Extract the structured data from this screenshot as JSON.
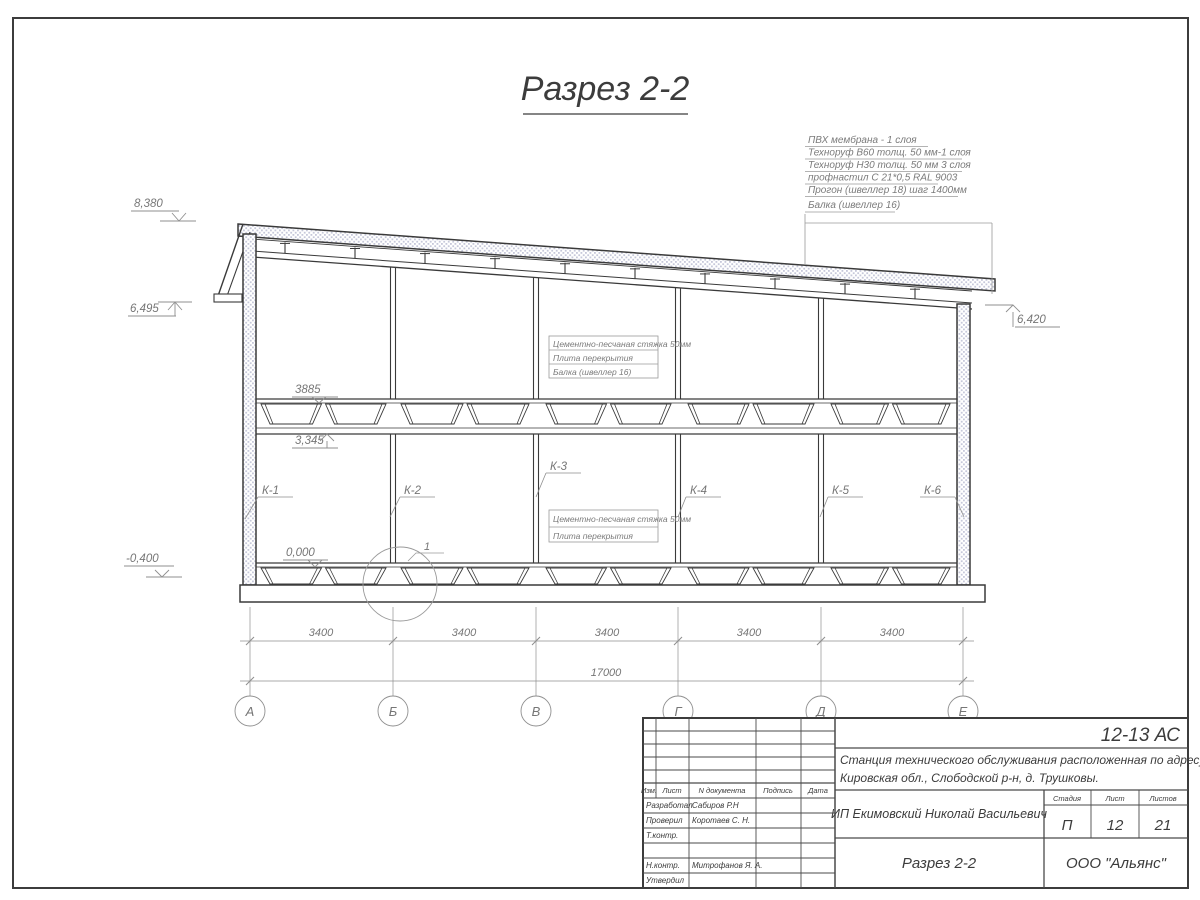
{
  "drawing": {
    "title": "Разрез 2-2"
  },
  "roof_callout": {
    "lines": [
      "ПВХ мембрана - 1 слоя",
      "Техноруф В60 толщ. 50 мм-1 слоя",
      "Техноруф Н30 толщ. 50 мм 3 слоя",
      "профнастил С 21*0,5 RAL 9003",
      "Прогон (швеллер 18) шаг 1400мм",
      "Балка (швеллер 16)"
    ]
  },
  "elevations": {
    "ridge": "8,380",
    "eave_left": "6,495",
    "eave_right": "6,420",
    "slab_top": "3885",
    "ceiling": "3,345",
    "floor": "0,000",
    "ground": "-0,400"
  },
  "notes": {
    "mid": [
      "Цементно-песчаная стяжка 50мм",
      "Плита перекрытия",
      "Балка (швеллер 16)"
    ],
    "floor": [
      "Цементно-песчаная стяжка 50мм",
      "Плита перекрытия"
    ]
  },
  "column_labels": [
    "К-1",
    "К-2",
    "К-3",
    "К-4",
    "К-5",
    "К-6"
  ],
  "detail_marker": "1",
  "dimensions": {
    "bays": [
      "3400",
      "3400",
      "3400",
      "3400",
      "3400"
    ],
    "total": "17000"
  },
  "axes": [
    "А",
    "Б",
    "В",
    "Г",
    "Д",
    "Е"
  ],
  "titleblock": {
    "code": "12-13 АС",
    "project_line1": "Станция технического обслуживания расположенная по адресу",
    "project_line2": "Кировская обл., Слободской р-н, д. Трушковы.",
    "client": "ИП Екимовский Николай Васильевич",
    "sheet_title": "Разрез 2-2",
    "company": "ООО \"Альянс\"",
    "cols": {
      "izm": "Изм.",
      "list": "Лист",
      "doc": "N документа",
      "sign": "Подпись",
      "date": "Дата"
    },
    "roles": {
      "developed": "Разработал",
      "checked": "Проверил",
      "tcontrol": "Т.контр.",
      "ncontrol": "Н.контр.",
      "approved": "Утвердил"
    },
    "names": {
      "developed": "Сабиров Р.Н",
      "checked": "Коротаев С. Н.",
      "ncontrol": "Митрофанов Я. А."
    },
    "stage": {
      "label": "Стадия",
      "value": "П"
    },
    "sheet": {
      "label": "Лист",
      "value": "12"
    },
    "sheets": {
      "label": "Листов",
      "value": "21"
    }
  }
}
